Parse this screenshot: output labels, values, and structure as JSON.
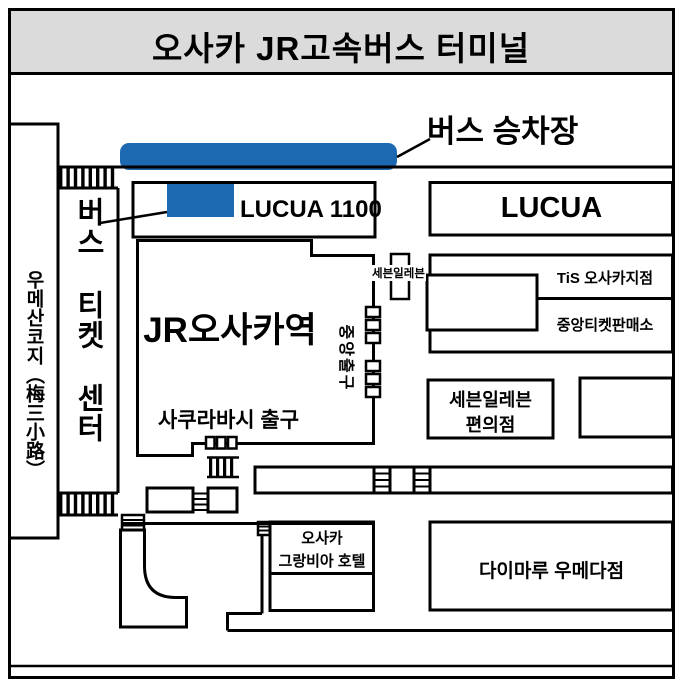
{
  "title": "오사카 JR고속버스 터미널",
  "colors": {
    "accent_blue": "#1c69b2",
    "title_background": "#dbdbdb",
    "line_black": "#000000"
  },
  "labels": {
    "bus_platform": "버스 승차장",
    "bus_ticket_center": "버스 티켓 센터",
    "umesankoji_road": "우메산코지（梅三小路）",
    "lucua_1100": "LUCUA 1100",
    "lucua": "LUCUA",
    "jr_osaka_station": "JR오사카역",
    "central_exit": "중앙출구",
    "seven_eleven_small": "세븐일레븐",
    "tis_osaka_branch": "TiS 오사카지점",
    "central_ticket_office": "중앙티켓판매소",
    "seven_eleven_store_line1": "세븐일레븐",
    "seven_eleven_store_line2": "편의점",
    "sakurabashi_exit": "사쿠라바시 출구",
    "hotel_line1": "오사카",
    "hotel_line2": "그랑비아 호텔",
    "daimaru_umeda": "다이마루 우메다점"
  }
}
